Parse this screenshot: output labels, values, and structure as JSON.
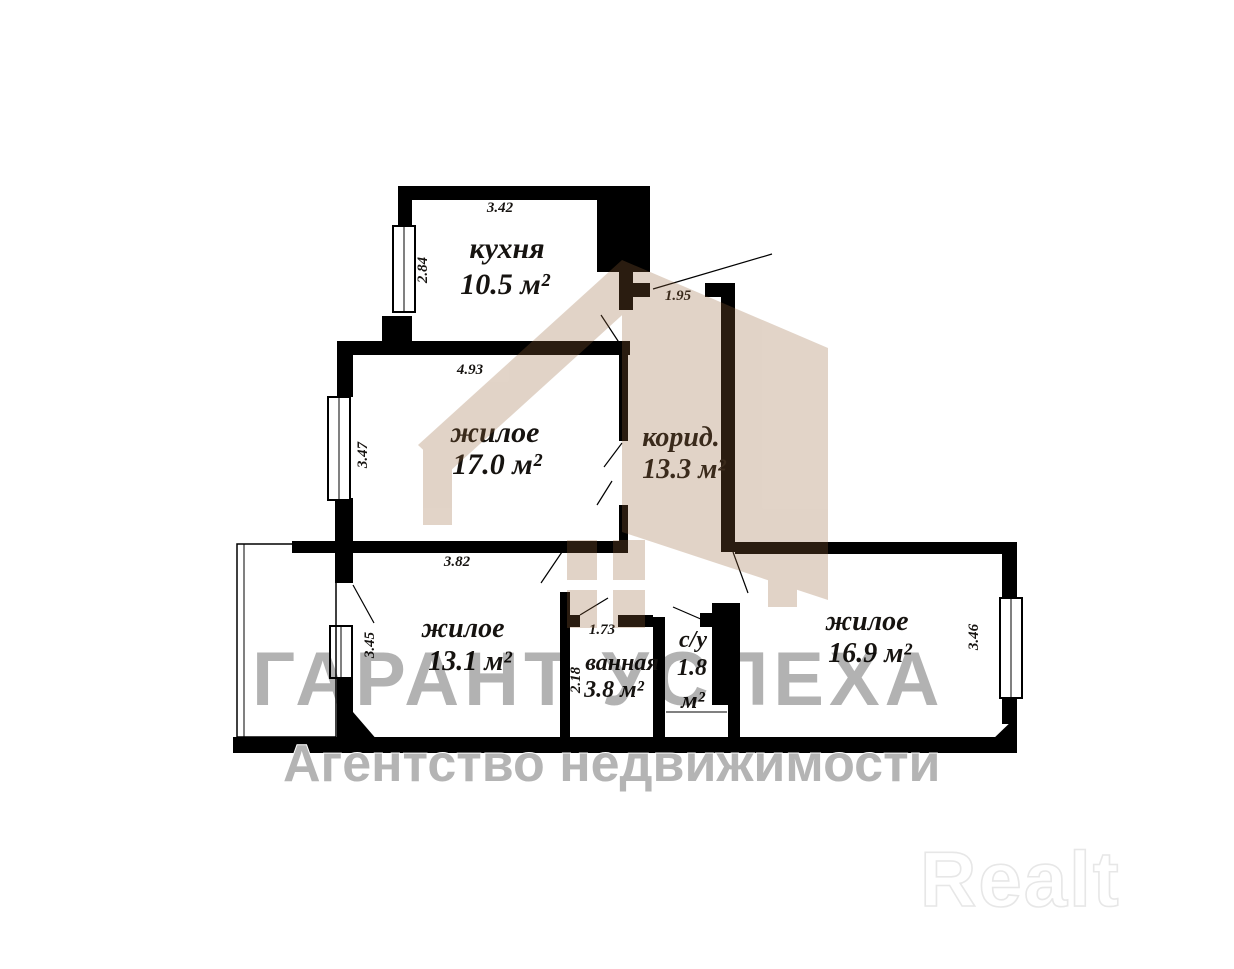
{
  "plan": {
    "rooms": {
      "kitchen": {
        "name": "кухня",
        "area": "10.5 м²"
      },
      "living1": {
        "name": "жилое",
        "area": "17.0 м²"
      },
      "corridor": {
        "name": "корид.",
        "area": "13.3 м²"
      },
      "living2": {
        "name": "жилое",
        "area": "13.1 м²"
      },
      "bath": {
        "name": "ванная",
        "area": "3.8 м²"
      },
      "wc": {
        "name": "с/у",
        "area_value": "1.8",
        "area_unit": "м²"
      },
      "living3": {
        "name": "жилое",
        "area": "16.9 м²"
      }
    },
    "dims": {
      "kitchen_w": "3.42",
      "kitchen_h": "2.84",
      "entry_w": "1.95",
      "living1_w": "4.93",
      "living1_h": "3.47",
      "living2_w": "3.82",
      "living2_h": "3.45",
      "bath_w": "1.73",
      "bath_h": "2.18",
      "living3_h": "3.46"
    }
  },
  "watermark": {
    "title": "ГАРАНТ УСПЕХА",
    "subtitle": "Агентство недвижимости",
    "brand": "Realt",
    "house_color": "#96653a",
    "gray_color": "#b4b4b4"
  }
}
